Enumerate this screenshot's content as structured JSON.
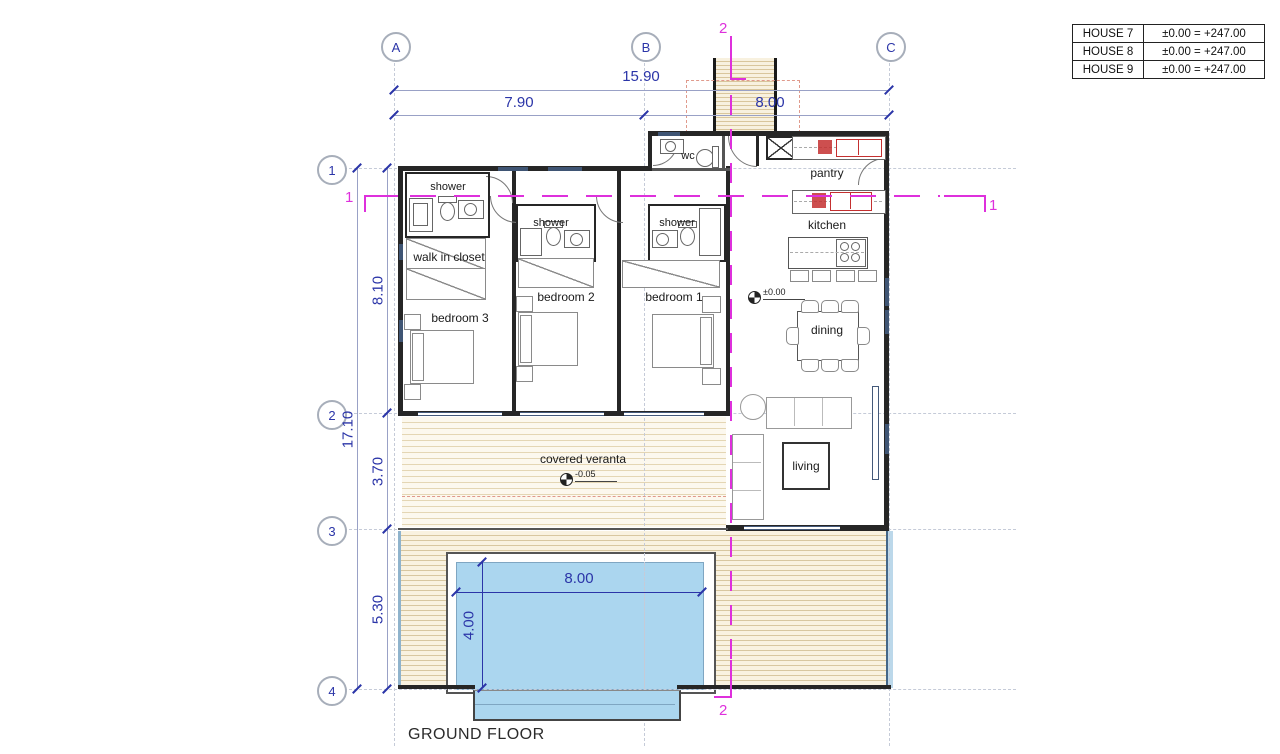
{
  "title_block": {
    "rows": [
      {
        "name": "HOUSE 7",
        "value": "±0.00 = +247.00"
      },
      {
        "name": "HOUSE 8",
        "value": "±0.00 = +247.00"
      },
      {
        "name": "HOUSE 9",
        "value": "±0.00 = +247.00"
      }
    ]
  },
  "grid": {
    "columns": [
      "A",
      "B",
      "C"
    ],
    "rows": [
      "1",
      "2",
      "3",
      "4"
    ]
  },
  "dimensions": {
    "overall_width": "15.90",
    "bay_left": "7.90",
    "bay_right": "8.00",
    "overall_depth": "17.10",
    "seg_1_2": "8.10",
    "seg_2_3": "3.70",
    "seg_3_4": "5.30",
    "pool_length": "8.00",
    "pool_width": "4.00"
  },
  "levels": {
    "ground": "±0.00",
    "veranda": "-0.05"
  },
  "sections": {
    "line_1": "1",
    "line_2": "2"
  },
  "rooms": {
    "shower": "shower",
    "wc": "wc",
    "pantry": "pantry",
    "kitchen": "kitchen",
    "walk_in_closet": "walk in closet",
    "bedroom_3": "bedroom 3",
    "bedroom_2": "bedroom 2",
    "bedroom_1": "bedroom 1",
    "dining": "dining",
    "living": "living",
    "veranda": "covered veranta"
  },
  "footer": {
    "drawing_title": "GROUND FLOOR"
  },
  "colors": {
    "dimension": "#2b35a8",
    "section": "#de30dc",
    "wall": "#262626",
    "pool_water": "#abd6ef",
    "deck_stripe": "#d8c7a0",
    "appliance": "#c43030"
  }
}
